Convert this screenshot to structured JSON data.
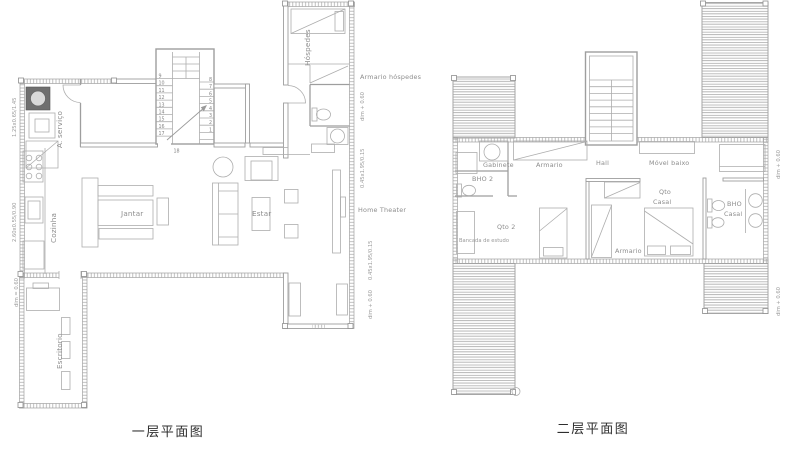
{
  "drawing": {
    "floor1": {
      "caption": "一层平面图",
      "labels": {
        "servico": "A. serviço",
        "cozinha": "Cozinha",
        "escritorio": "Escritorio",
        "jantar": "Jantar",
        "estar": "Estar",
        "hospedes": "Hóspedes",
        "armario_hospedes": "Armario hóspedes",
        "home_theater": "Home Theater"
      },
      "dims": {
        "window_servico": "1.25x0.65/1.45",
        "window_cozinha": "2.60x0.55/0.90",
        "level_escritorio": "dim = 0.60",
        "level_hospedes": "dim + 0.60",
        "window_estar_1": "0.45x1.95/0.15",
        "window_estar_2": "0.45x1.95/0.15",
        "level_home_theater": "dim + 0.60"
      },
      "stairs": {
        "left": [
          "9",
          "10",
          "11",
          "12",
          "13",
          "14",
          "15",
          "16",
          "17"
        ],
        "right": [
          "8",
          "7",
          "6",
          "5",
          "4",
          "3",
          "2",
          "1"
        ],
        "bottom": "18"
      }
    },
    "floor2": {
      "caption": "二层平面图",
      "labels": {
        "gabinete": "Gabinete",
        "bho2": "BHO 2",
        "armario_top": "Armario",
        "hall": "Hall",
        "movel_baixo": "Móvel baixo",
        "qto2": "Qto 2",
        "bancada": "Bancada de estudo",
        "armario_mid": "Armario",
        "qto_casal_line1": "Qto",
        "qto_casal_line2": "Casal",
        "bho_casal_line1": "BHO",
        "bho_casal_line2": "Casal"
      },
      "dims": {
        "level_right_top": "dim + 0.60",
        "level_right_bottom": "dim + 0.60"
      }
    }
  }
}
